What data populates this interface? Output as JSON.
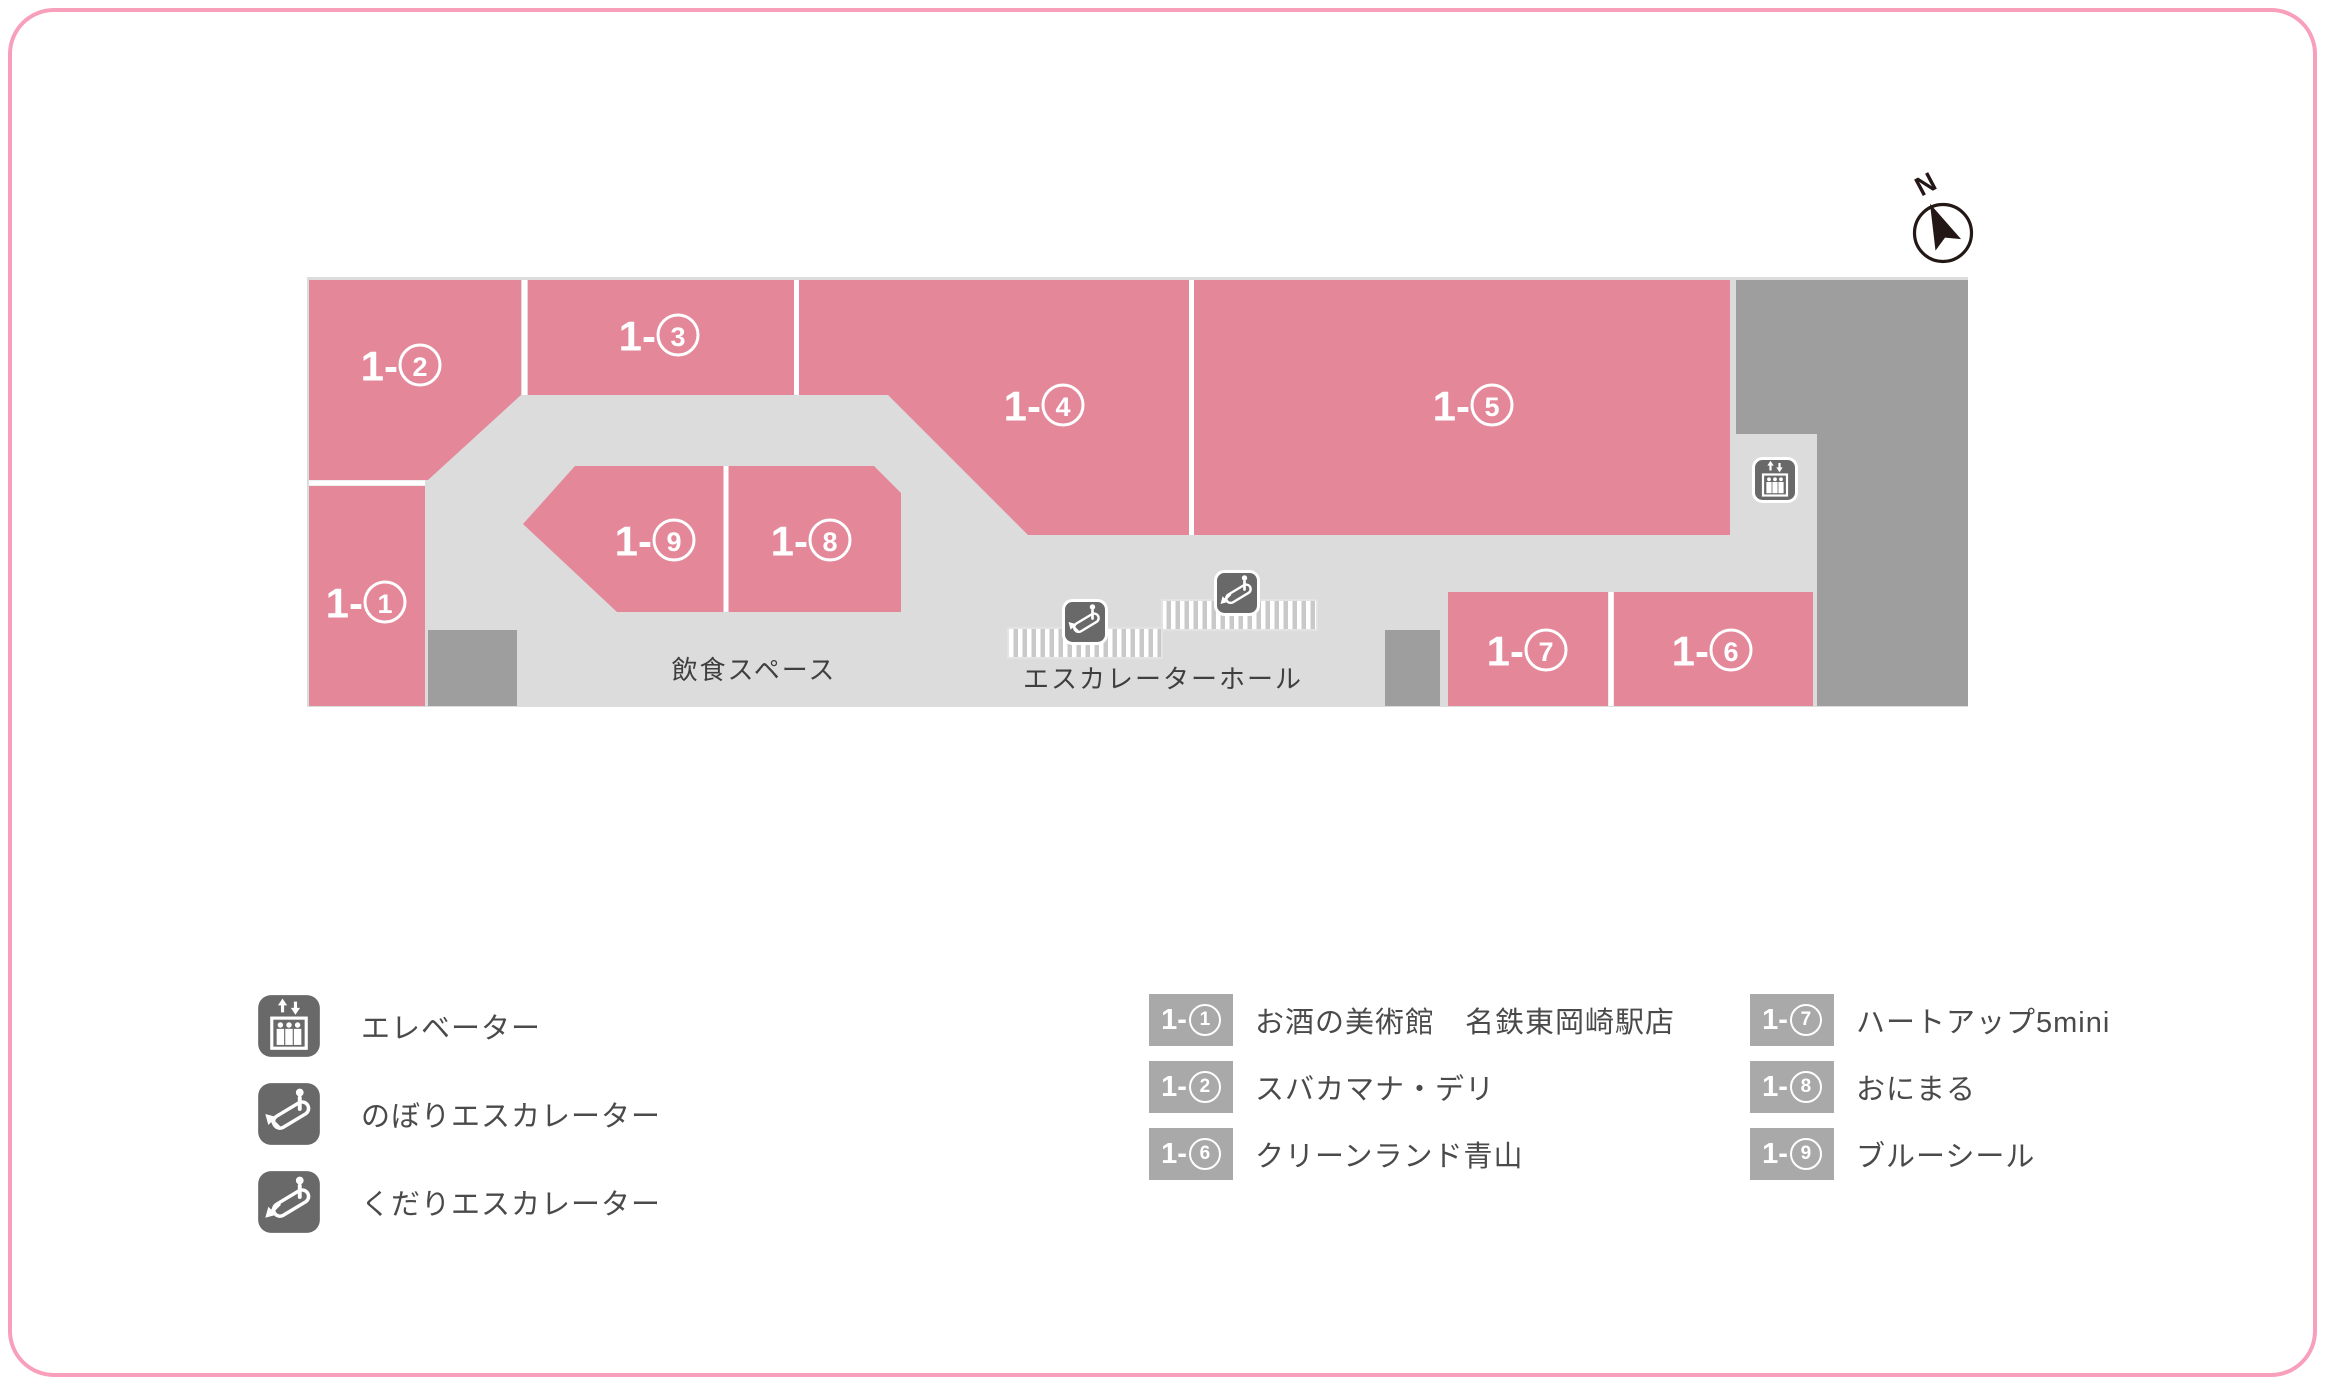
{
  "page": {
    "background": "#ffffff",
    "frame_border_color": "#f89fbc"
  },
  "map": {
    "floor_color": "#dcdcdd",
    "unit_color": "#e38799",
    "backyard_color": "#9e9e9e",
    "icon_bg_color": "#696969",
    "stripe_color": "#c9c9c9",
    "label_color": "#ffffff",
    "units": [
      {
        "prefix": "1-",
        "digit": "1",
        "label": "1-①"
      },
      {
        "prefix": "1-",
        "digit": "2",
        "label": "1-②"
      },
      {
        "prefix": "1-",
        "digit": "3",
        "label": "1-③"
      },
      {
        "prefix": "1-",
        "digit": "4",
        "label": "1-④"
      },
      {
        "prefix": "1-",
        "digit": "5",
        "label": "1-⑤"
      },
      {
        "prefix": "1-",
        "digit": "6",
        "label": "1-⑥"
      },
      {
        "prefix": "1-",
        "digit": "7",
        "label": "1-⑦"
      },
      {
        "prefix": "1-",
        "digit": "8",
        "label": "1-⑧"
      },
      {
        "prefix": "1-",
        "digit": "9",
        "label": "1-⑨"
      }
    ],
    "areas": {
      "dining": "飲食スペース",
      "escalator_hall": "エスカレーターホール"
    },
    "compass": {
      "label": "N"
    }
  },
  "legend": {
    "items": [
      {
        "icon": "elevator-icon",
        "label": "エレベーター"
      },
      {
        "icon": "escalator-up-icon",
        "label": "のぼりエスカレーター"
      },
      {
        "icon": "escalator-down-icon",
        "label": "くだりエスカレーター"
      }
    ]
  },
  "directory": {
    "badge_color": "#a9a9a9",
    "text_color": "#4a4a4a",
    "columns": [
      [
        {
          "prefix": "1-",
          "digit": "1",
          "name": "お酒の美術館　名鉄東岡崎駅店"
        },
        {
          "prefix": "1-",
          "digit": "2",
          "name": "スバカマナ・デリ"
        },
        {
          "prefix": "1-",
          "digit": "6",
          "name": "クリーンランド青山"
        }
      ],
      [
        {
          "prefix": "1-",
          "digit": "7",
          "name": "ハートアップ5mini"
        },
        {
          "prefix": "1-",
          "digit": "8",
          "name": "おにまる"
        },
        {
          "prefix": "1-",
          "digit": "9",
          "name": "ブルーシール"
        }
      ]
    ]
  }
}
